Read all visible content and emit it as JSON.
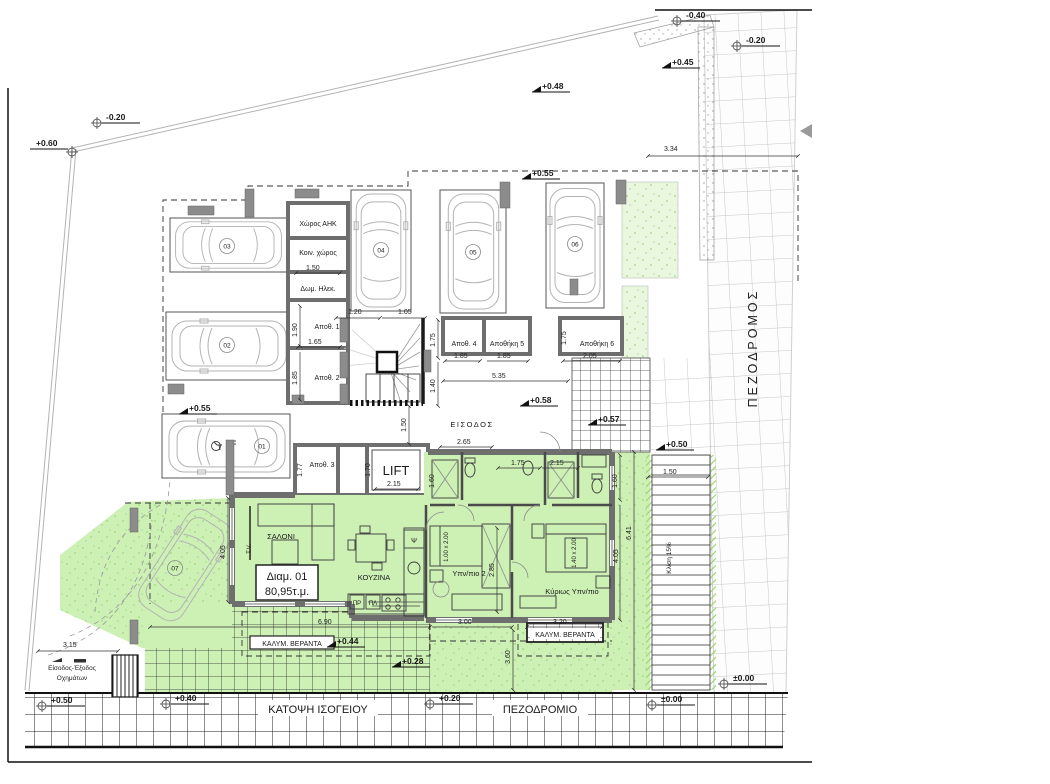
{
  "colors": {
    "apartment_green": "#cdf0b5",
    "vegetation_dot_green": "#8fcf6b",
    "wall_gray": "#6e6e6e",
    "grid_black": "#1c1c1c",
    "pedestrian_grid_gray": "#c6c6c6"
  },
  "titles": {
    "plan": "ΚΑΤΟΨΗ ΙΣΟΓΕΙΟΥ",
    "sidewalk": "ΠΕΖΟΔΡΟΜΙΟ",
    "pedestrian_way": "ΠΕΖΟΔΡΟΜΟΣ"
  },
  "apartment": {
    "id": "Διαμ. 01",
    "area": "80,95τ.μ.",
    "living_room": "ΣΑΛΟΝΙ",
    "kitchen": "ΚΟΥΖΙΝΑ",
    "bedroom2": "Υπν/πιο 2",
    "master_bedroom": "Κύριως Υπν/πιο",
    "tv": "T.V.",
    "fridge": "Ψ",
    "washer": "ΠΡ",
    "dryer": "ΠΛ",
    "covered_veranda_left": "ΚΑΛΥΜ. ΒΕΡΑΝΤΑ",
    "covered_veranda_right": "ΚΑΛΥΜ. ΒΕΡΑΝΤΑ",
    "bed_single": "1.00 x 2.00",
    "bed_double": "1.40 x 2.00"
  },
  "common_areas": {
    "entrance": "ΕΙΣΟΔΟΣ",
    "lift": "LIFT",
    "ahk_room": "Χώρος ΑΗΚ",
    "communal_space": "Κοιν. χώρος",
    "electrical_room": "Δωμ. Ηλεκ.",
    "storage_1": "Αποθ. 1",
    "storage_2": "Αποθ. 2",
    "storage_3": "Αποθ. 3",
    "storage_4": "Αποθ. 4",
    "storage_5": "Αποθήκη 5",
    "storage_6": "Αποθήκη 6",
    "ramp_slope": "Κλίση 15%",
    "vehicle_access_line1": "Είσοδος-Έξοδος",
    "vehicle_access_line2": "Οχημάτων"
  },
  "parking": {
    "s1": "01",
    "s2": "02",
    "s3": "03",
    "s4": "04",
    "s5": "05",
    "s6": "06",
    "s7": "07"
  },
  "elevations": {
    "top_right_1": "-0.40",
    "top_right_2": "-0.20",
    "top_right_3": "+0.45",
    "top_1": "+0.48",
    "top_2": "+0.55",
    "top_left_1": "-0.20",
    "top_left_2": "+0.60",
    "parking": "+0.55",
    "entrance": "+0.58",
    "courtyard": "+0.57",
    "ramp_top": "+0.50",
    "veranda": "+0.44",
    "garden": "+0.28",
    "bottom_left": "+0.50",
    "sidewalk_1": "+0.40",
    "sidewalk_2": "+0.20",
    "sidewalk_3": "±0.00",
    "ramp_bottom": "±0.00"
  },
  "dimensions": {
    "d_3_34": "3.34",
    "d_3_15": "3.15",
    "d_1_20": "1.20",
    "d_1_05": "1.05",
    "d_1_50_comm": "1.50",
    "d_1_65": "1.65",
    "d_1_90": "1.90",
    "d_1_85_st2": "1.85",
    "d_1_77": "1.77",
    "d_1_70": "1.70",
    "d_2_15_lift": "2.15",
    "d_1_75_st4": "1.75",
    "d_1_40": "1.40",
    "d_1_85_a": "1.85",
    "d_1_85_b": "1.85",
    "d_2_05": "2.05",
    "d_1_75_st6": "1.75",
    "d_5_35": "5.35",
    "d_1_50_hall": "1.50",
    "d_2_65": "2.65",
    "d_1_75_bath": "1.75",
    "d_2_15_bath": "2.15",
    "d_1_60_a": "1.60",
    "d_1_60_b": "1.60",
    "d_4_05_left": "4.05",
    "d_2_85": "2.85",
    "d_3_00": "3.00",
    "d_3_20": "3.20",
    "d_6_90": "6.90",
    "d_3_60": "3.60",
    "d_4_05_right": "4.05",
    "d_6_41": "6.41",
    "d_1_50_ramp": "1.50"
  }
}
